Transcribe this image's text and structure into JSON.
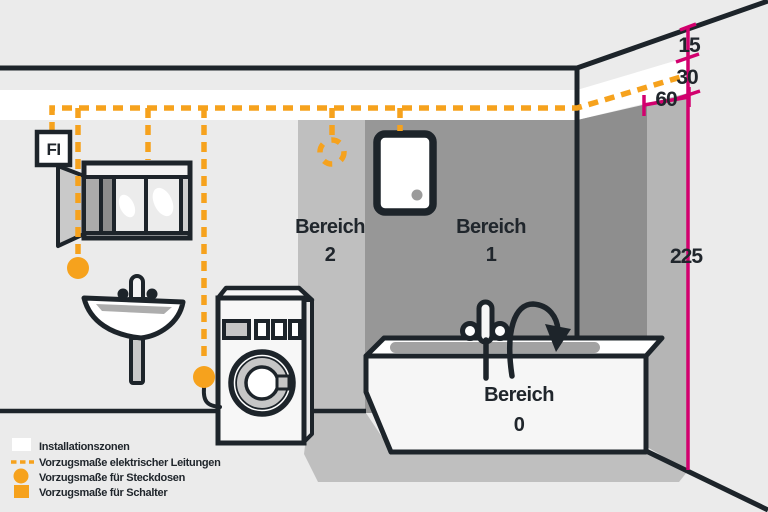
{
  "diagram": {
    "fi_label": "FI",
    "zones": {
      "zone2": {
        "name": "Bereich",
        "number": "2"
      },
      "zone1": {
        "name": "Bereich",
        "number": "1"
      },
      "zone0": {
        "name": "Bereich",
        "number": "0"
      }
    },
    "measurements": {
      "ceiling_offset": "15",
      "band_height": "30",
      "side_zone_width": "60",
      "zone_height": "225"
    },
    "legend": {
      "items": [
        {
          "swatch": "white-square",
          "label": "Installationszonen"
        },
        {
          "swatch": "orange-dashed-line",
          "label": "Vorzugsmaße elektrischer Leitungen"
        },
        {
          "swatch": "orange-circle",
          "label": "Vorzugsmaße für Steckdosen"
        },
        {
          "swatch": "orange-square",
          "label": "Vorzugsmaße für Schalter"
        }
      ]
    },
    "colors": {
      "accent_orange": "#F6A21D",
      "accent_magenta": "#D2006E",
      "outline_dark": "#1D242A",
      "installation_zone_white": "#FFFFFF",
      "zone2_gray": "#BFBFBF",
      "zone1_gray": "#979797",
      "background_gray": "#EBEBEB"
    }
  }
}
